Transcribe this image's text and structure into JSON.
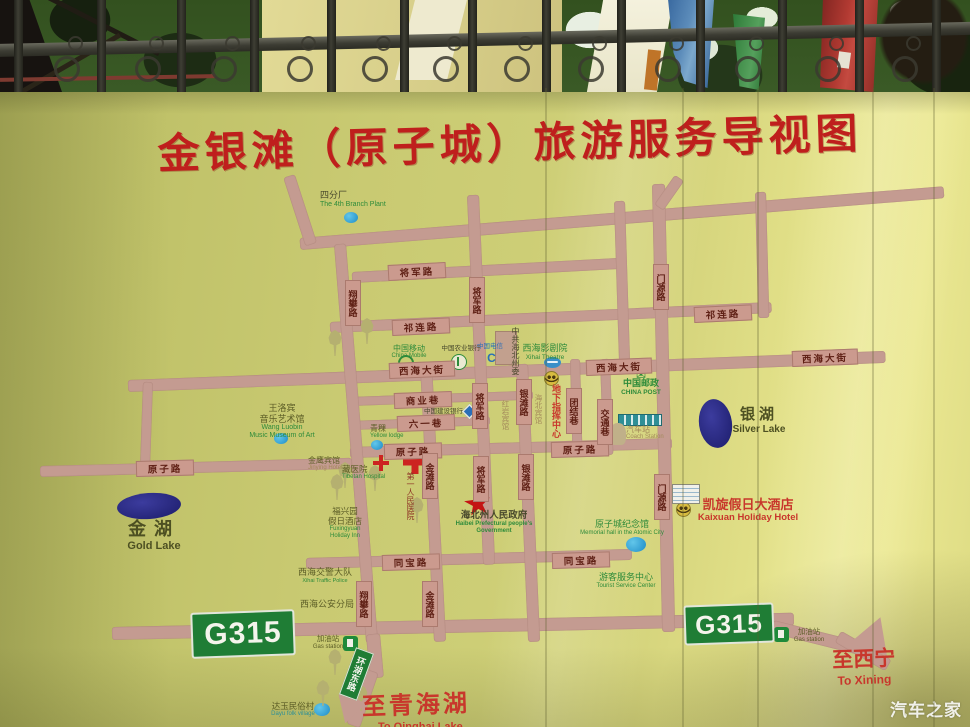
{
  "title": "金银滩（原子城）旅游服务导视图",
  "watermark": "汽车之家",
  "colors": {
    "olive": "#5c5d26",
    "green": "#2e8b3a",
    "red": "#c8372c",
    "blue": "#2a6fb8",
    "dark": "#47472b",
    "tan": "#a3895a",
    "maroon": "#8e3526",
    "teal": "#2e8f96",
    "lake": "#4d5022"
  },
  "map": {
    "roads": [
      [
        300,
        238,
        646,
        12,
        -4.6
      ],
      [
        352,
        272,
        272,
        11,
        -3
      ],
      [
        330,
        322,
        442,
        11,
        -2.6
      ],
      [
        128,
        380,
        758,
        12,
        -2.2
      ],
      [
        350,
        397,
        183,
        9,
        -2
      ],
      [
        350,
        421,
        140,
        9,
        -2
      ],
      [
        350,
        447,
        322,
        11,
        -1.6
      ],
      [
        40,
        466,
        312,
        11,
        -1.5
      ],
      [
        306,
        558,
        326,
        11,
        -1.6
      ],
      [
        112,
        627,
        682,
        13,
        -1.2
      ],
      [
        772,
        620,
        100,
        13,
        14
      ],
      [
        838,
        630,
        58,
        13,
        30
      ],
      [
        283,
        176,
        12,
        72,
        -18
      ],
      [
        334,
        244,
        12,
        400,
        -4.6
      ],
      [
        366,
        634,
        14,
        44,
        -5
      ],
      [
        365,
        671,
        14,
        58,
        19
      ],
      [
        467,
        195,
        12,
        370,
        -2.5
      ],
      [
        420,
        364,
        12,
        278,
        -2.9
      ],
      [
        516,
        364,
        12,
        278,
        -2.5
      ],
      [
        570,
        359,
        10,
        96,
        -1.5
      ],
      [
        600,
        359,
        10,
        96,
        -2
      ],
      [
        652,
        184,
        13,
        448,
        -1.3
      ],
      [
        674,
        178,
        11,
        36,
        35
      ],
      [
        614,
        201,
        11,
        165,
        -1.8
      ],
      [
        755,
        192,
        11,
        126,
        -1.5
      ],
      [
        143,
        382,
        10,
        90,
        2
      ]
    ],
    "plates": [
      {
        "t": "将军路",
        "x": 388,
        "y": 265,
        "r": -3
      },
      {
        "t": "祁连路",
        "x": 392,
        "y": 320,
        "r": -2.6
      },
      {
        "t": "祁连路",
        "x": 694,
        "y": 307,
        "r": -2.6
      },
      {
        "t": "西海大街",
        "x": 389,
        "y": 363,
        "r": -2.2,
        "w": 64
      },
      {
        "t": "西海大街",
        "x": 586,
        "y": 360,
        "r": -2.2,
        "w": 64
      },
      {
        "t": "西海大街",
        "x": 792,
        "y": 351,
        "r": -2.2,
        "w": 64
      },
      {
        "t": "商业巷",
        "x": 394,
        "y": 393,
        "r": -2
      },
      {
        "t": "六一巷",
        "x": 397,
        "y": 416,
        "r": -2
      },
      {
        "t": "原子路",
        "x": 384,
        "y": 444,
        "r": -1.6
      },
      {
        "t": "原子路",
        "x": 551,
        "y": 442,
        "r": -1.6
      },
      {
        "t": "原子路",
        "x": 136,
        "y": 461,
        "r": -1.5
      },
      {
        "t": "同宝路",
        "x": 382,
        "y": 555,
        "r": -1.6
      },
      {
        "t": "同宝路",
        "x": 552,
        "y": 553,
        "r": -1.6
      },
      {
        "t": "翔攀路",
        "x": 345,
        "y": 280,
        "v": 1
      },
      {
        "t": "将军路",
        "x": 469,
        "y": 277,
        "v": 1
      },
      {
        "t": "门源路",
        "x": 653,
        "y": 264,
        "v": 1
      },
      {
        "t": "将军路",
        "x": 472,
        "y": 383,
        "v": 1
      },
      {
        "t": "银滩路",
        "x": 516,
        "y": 379,
        "v": 1
      },
      {
        "t": "团结巷",
        "x": 566,
        "y": 388,
        "v": 1
      },
      {
        "t": "交通巷",
        "x": 597,
        "y": 399,
        "v": 1
      },
      {
        "t": "金滩路",
        "x": 422,
        "y": 453,
        "v": 1
      },
      {
        "t": "银滩路",
        "x": 518,
        "y": 454,
        "v": 1
      },
      {
        "t": "将军路",
        "x": 473,
        "y": 456,
        "v": 1
      },
      {
        "t": "门源路",
        "x": 654,
        "y": 474,
        "v": 1
      },
      {
        "t": "金滩路",
        "x": 422,
        "y": 581,
        "v": 1
      },
      {
        "t": "翔攀路",
        "x": 356,
        "y": 581,
        "v": 1
      }
    ],
    "pois": [
      {
        "x": 320,
        "y": 190,
        "zh": "四分厂",
        "en": "The 4th Branch Plant",
        "cz": "dark",
        "ce": "green",
        "fz": 9,
        "fe": 7
      },
      {
        "x": 232,
        "y": 403,
        "zh": "王洛宾\n音乐艺术馆",
        "en": "Wang Luobin\nMusic Museum of Art",
        "cz": "olive",
        "ce": "green",
        "fz": 9,
        "fe": 7,
        "ctr": 1,
        "w": 100
      },
      {
        "x": 370,
        "y": 424,
        "zh": "青稞",
        "en": "Yellow lodge",
        "cz": "olive",
        "ce": "green",
        "fz": 8,
        "fe": 6
      },
      {
        "x": 308,
        "y": 456,
        "zh": "金鹰宾馆",
        "en": "Jinying Hotel",
        "cz": "olive",
        "ce": "tan",
        "fz": 8,
        "fe": 6
      },
      {
        "x": 342,
        "y": 464,
        "zh": "藏医院",
        "en": "Tibetan Hospital",
        "cz": "olive",
        "ce": "green",
        "fz": 8.5,
        "fe": 6
      },
      {
        "x": 402,
        "y": 472,
        "zh": "第一人民医院",
        "cz": "maroon",
        "fz": 8,
        "v": 1,
        "h": 80
      },
      {
        "x": 390,
        "y": 344,
        "zh": "中国移动",
        "en": "China Mobile",
        "cz": "green",
        "ce": "green",
        "fz": 8,
        "fe": 6,
        "ctr": 1,
        "w": 38
      },
      {
        "x": 440,
        "y": 345,
        "zh": "中国农业银行",
        "cz": "dark",
        "fz": 6.5,
        "ctr": 1,
        "w": 42
      },
      {
        "x": 477,
        "y": 343,
        "zh": "中国电信",
        "cz": "blue",
        "fz": 6.5
      },
      {
        "x": 507,
        "y": 327,
        "zh": "中共海北州委",
        "cz": "dark",
        "fz": 8,
        "v": 1,
        "h": 74
      },
      {
        "x": 518,
        "y": 343,
        "zh": "西海影剧院",
        "en": "Xihai Theatre",
        "cz": "green",
        "ce": "green",
        "fz": 9,
        "fe": 6.5,
        "ctr": 1,
        "w": 54
      },
      {
        "x": 618,
        "y": 378,
        "zh": "中国邮政",
        "en": "CHINA POST",
        "cz": "green",
        "ce": "green",
        "fz": 9,
        "fe": 6.5,
        "ctr": 1,
        "w": 46,
        "bold": 1
      },
      {
        "x": 548,
        "y": 384,
        "zh": "地下指挥中心",
        "cz": "red",
        "fz": 9,
        "v": 1,
        "h": 82,
        "bold": 1
      },
      {
        "x": 530,
        "y": 394,
        "zh": "海北宾馆",
        "cz": "tan",
        "fz": 7.5,
        "v": 1,
        "h": 48
      },
      {
        "x": 497,
        "y": 400,
        "zh": "红岩宾馆",
        "cz": "tan",
        "fz": 7.5,
        "v": 1,
        "h": 48
      },
      {
        "x": 424,
        "y": 408,
        "zh": "中国建设银行",
        "cz": "dark",
        "fz": 6.5
      },
      {
        "x": 626,
        "y": 425,
        "zh": "汽车站",
        "en": "Coach Station",
        "cz": "tan",
        "ce": "tan",
        "fz": 8,
        "fe": 6
      },
      {
        "x": 438,
        "y": 510,
        "zh": "海北州人民政府",
        "en": "Haibei Prefectural people's Government",
        "cz": "dark",
        "ce": "green",
        "fz": 9.5,
        "fe": 6,
        "ctr": 1,
        "w": 112,
        "bold": 1
      },
      {
        "x": 576,
        "y": 519,
        "zh": "原子城纪念馆",
        "en": "Memorial hall in the Atomic City",
        "cz": "green",
        "ce": "green",
        "fz": 9,
        "fe": 6,
        "ctr": 1,
        "w": 92
      },
      {
        "x": 686,
        "y": 497,
        "zh": "凯旋假日大酒店",
        "en": "Kaixuan Holiday Hotel",
        "cz": "red",
        "ce": "red",
        "fz": 13,
        "fe": 9.5,
        "ctr": 1,
        "w": 124,
        "bold": 1
      },
      {
        "x": 316,
        "y": 506,
        "zh": "福兴园\n假日酒店",
        "en": "Fuxingyuan\nHoliday Inn",
        "cz": "olive",
        "ce": "green",
        "fz": 8.5,
        "fe": 6,
        "ctr": 1,
        "w": 58
      },
      {
        "x": 292,
        "y": 567,
        "zh": "西海交警大队",
        "en": "Xihai Traffic Police",
        "cz": "olive",
        "ce": "green",
        "fz": 9,
        "fe": 5.5,
        "ctr": 1,
        "w": 66
      },
      {
        "x": 300,
        "y": 599,
        "zh": "西海公安分局",
        "cz": "olive",
        "fz": 9
      },
      {
        "x": 592,
        "y": 572,
        "zh": "游客服务中心",
        "en": "Tourist Service Center",
        "cz": "green",
        "ce": "green",
        "fz": 9,
        "fe": 6,
        "ctr": 1,
        "w": 68
      },
      {
        "x": 266,
        "y": 701,
        "zh": "达玉民俗村",
        "en": "Dayu folk village",
        "cz": "olive",
        "ce": "teal",
        "fz": 8.5,
        "fe": 6,
        "ctr": 1,
        "w": 54
      },
      {
        "x": 312,
        "y": 635,
        "zh": "加油站",
        "en": "Gas station",
        "cz": "olive",
        "ce": "olive",
        "fz": 7.5,
        "fe": 6,
        "ctr": 1,
        "w": 32
      },
      {
        "x": 792,
        "y": 628,
        "zh": "加油站",
        "en": "Gas station",
        "cz": "olive",
        "ce": "olive",
        "fz": 7.5,
        "fe": 6,
        "ctr": 1,
        "w": 34
      },
      {
        "x": 362,
        "y": 692,
        "zh": "至青海湖",
        "cz": "red",
        "fz": 24,
        "bold": 1,
        "lsp": 3,
        "rot": -2
      },
      {
        "x": 826,
        "y": 648,
        "zh": "至西宁",
        "en": "To Xining",
        "cz": "red",
        "ce": "red",
        "fz": 21,
        "fe": 12,
        "bold": 1,
        "ctr": 1,
        "w": 76,
        "rot": -2
      },
      {
        "x": 378,
        "y": 721,
        "zh": "",
        "en": "To Qinghai Lake",
        "ce": "red",
        "fe": 11,
        "bold": 1
      }
    ],
    "lakes": [
      {
        "x": 117,
        "y": 493,
        "w": 64,
        "h": 26,
        "rot": -4,
        "zh": "金湖",
        "en": "Gold Lake",
        "lx": 122,
        "ly": 519,
        "fz": 18,
        "fe": 11,
        "lsp": 8,
        "lw": 64
      },
      {
        "x": 699,
        "y": 399,
        "w": 33,
        "h": 49,
        "rot": -8,
        "zh": "银湖",
        "en": "Silver Lake",
        "lx": 731,
        "ly": 406,
        "fz": 15,
        "fe": 10,
        "lsp": 4,
        "lw": 56
      }
    ],
    "g315": [
      {
        "t": "G315",
        "x": 191,
        "y": 611,
        "w": 100,
        "h": 42,
        "fs": 30,
        "rot": -2
      },
      {
        "t": "G315",
        "x": 684,
        "y": 604,
        "w": 86,
        "h": 36,
        "fs": 26,
        "rot": -2
      }
    ],
    "ring_road_sign": {
      "text": "环湖东路",
      "x": 347,
      "y": 649,
      "w": 17,
      "h": 48,
      "rot": 20
    },
    "marks": [
      [
        "dot",
        344,
        212,
        14,
        11
      ],
      [
        "dot",
        274,
        433,
        14,
        11
      ],
      [
        "dot",
        371,
        440,
        12,
        10
      ],
      [
        "dot",
        626,
        537,
        20,
        15
      ],
      [
        "dot",
        314,
        703,
        16,
        13
      ],
      [
        "tree",
        328,
        330
      ],
      [
        "tree",
        360,
        318
      ],
      [
        "tree",
        338,
        462
      ],
      [
        "tree",
        368,
        465
      ],
      [
        "tree",
        330,
        474
      ],
      [
        "tree",
        410,
        497
      ],
      [
        "tree",
        328,
        649
      ],
      [
        "tree",
        316,
        680
      ],
      [
        "tree",
        354,
        685
      ],
      [
        "star",
        464,
        490,
        27
      ],
      [
        "cross",
        373,
        455,
        16
      ],
      [
        "cross",
        403,
        450,
        24
      ],
      [
        "smiley",
        545,
        372
      ],
      [
        "smiley",
        677,
        503
      ],
      [
        "gas",
        343,
        636
      ],
      [
        "gas",
        774,
        627
      ],
      [
        "coach",
        618,
        414,
        42,
        10
      ],
      [
        "hotel",
        672,
        484,
        26,
        18
      ],
      [
        "bldg",
        495,
        331,
        20,
        32
      ],
      [
        "lmobile",
        398,
        355
      ],
      [
        "lab",
        451,
        354
      ],
      [
        "lct",
        484,
        350
      ],
      [
        "lccb",
        464,
        406
      ],
      [
        "lpost",
        636,
        368
      ],
      [
        "ltheatre",
        544,
        357
      ],
      [
        "ahead",
        856,
        626,
        40,
        34,
        140
      ],
      [
        "ahead",
        334,
        698,
        30,
        26,
        197
      ]
    ]
  },
  "fence": {
    "bars": [
      14,
      97,
      177,
      250,
      327,
      400,
      468,
      542,
      617,
      696,
      778,
      855,
      932
    ],
    "scrolls": [
      54,
      135,
      211,
      287,
      362,
      433,
      504,
      578,
      655,
      735,
      815,
      892
    ]
  },
  "seams": [
    545,
    682,
    757,
    872,
    933
  ]
}
